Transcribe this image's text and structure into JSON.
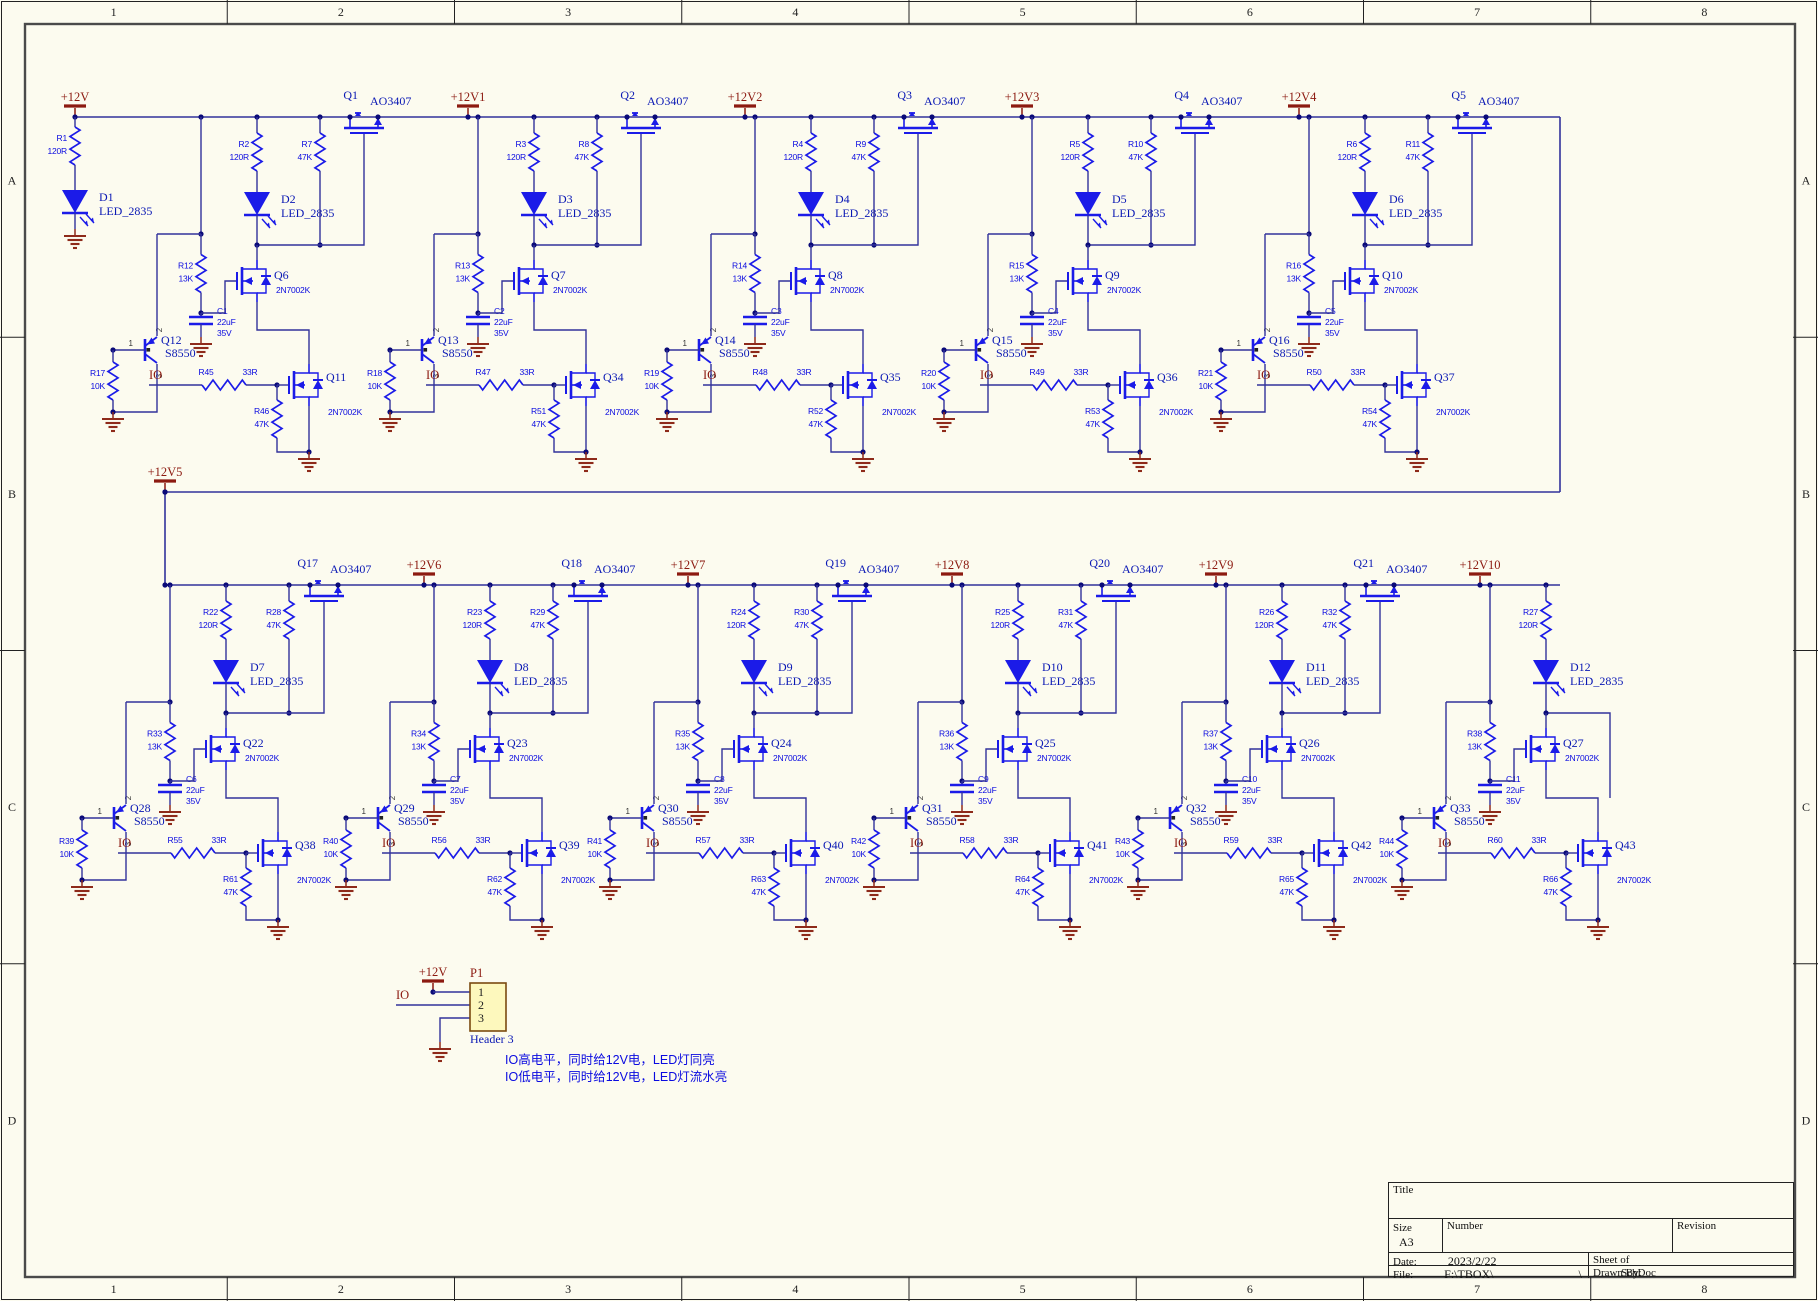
{
  "sheet": {
    "zones_cols": [
      "1",
      "2",
      "3",
      "4",
      "5",
      "6",
      "7",
      "8"
    ],
    "zones_rows": [
      "A",
      "B",
      "C",
      "D"
    ]
  },
  "colors": {
    "background": "#fcfbef",
    "wire": "#32329b",
    "part": "#1b1be8",
    "label": "#0a0ae0",
    "ref": "#0a18b4",
    "net": "#8c1a10",
    "ground": "#8e2a1a",
    "dot": "#0a0a78",
    "connector_fill": "#fdf8bd",
    "connector_stroke": "#7a4a10"
  },
  "power": {
    "main": "+12V",
    "mid": "+12V5"
  },
  "io_label": "IO",
  "first_led": {
    "res_ref": "R1",
    "res_val": "120R",
    "led_ref": "D1",
    "led_val": "LED_2835"
  },
  "pnp_pins": [
    "1",
    "2",
    "3"
  ],
  "top_units": [
    {
      "rail": "+12V1",
      "pass_ref": "Q1",
      "pass_val": "AO3407",
      "rled_ref": "R2",
      "rled_val": "120R",
      "led_ref": "D2",
      "led_val": "LED_2835",
      "r47_ref": "R7",
      "r47_val": "47K",
      "r13_ref": "R12",
      "r13_val": "13K",
      "qn_ref": "Q6",
      "qn_val": "2N7002K",
      "cap_ref": "C1",
      "cap_v1": "22uF",
      "cap_v2": "35V",
      "pnp_ref": "Q12",
      "pnp_val": "S8550",
      "r10_ref": "R17",
      "r10_val": "10K",
      "rio_ref": "R45",
      "rio_val": "33R",
      "qio_ref": "Q11",
      "qio_val": "2N7002K",
      "rpd_ref": "R46",
      "rpd_val": "47K"
    },
    {
      "rail": "+12V2",
      "pass_ref": "Q2",
      "pass_val": "AO3407",
      "rled_ref": "R3",
      "rled_val": "120R",
      "led_ref": "D3",
      "led_val": "LED_2835",
      "r47_ref": "R8",
      "r47_val": "47K",
      "r13_ref": "R13",
      "r13_val": "13K",
      "qn_ref": "Q7",
      "qn_val": "2N7002K",
      "cap_ref": "C2",
      "cap_v1": "22uF",
      "cap_v2": "35V",
      "pnp_ref": "Q13",
      "pnp_val": "S8550",
      "r10_ref": "R18",
      "r10_val": "10K",
      "rio_ref": "R47",
      "rio_val": "33R",
      "qio_ref": "Q34",
      "qio_val": "2N7002K",
      "rpd_ref": "R51",
      "rpd_val": "47K"
    },
    {
      "rail": "+12V3",
      "pass_ref": "Q3",
      "pass_val": "AO3407",
      "rled_ref": "R4",
      "rled_val": "120R",
      "led_ref": "D4",
      "led_val": "LED_2835",
      "r47_ref": "R9",
      "r47_val": "47K",
      "r13_ref": "R14",
      "r13_val": "13K",
      "qn_ref": "Q8",
      "qn_val": "2N7002K",
      "cap_ref": "C3",
      "cap_v1": "22uF",
      "cap_v2": "35V",
      "pnp_ref": "Q14",
      "pnp_val": "S8550",
      "r10_ref": "R19",
      "r10_val": "10K",
      "rio_ref": "R48",
      "rio_val": "33R",
      "qio_ref": "Q35",
      "qio_val": "2N7002K",
      "rpd_ref": "R52",
      "rpd_val": "47K"
    },
    {
      "rail": "+12V4",
      "pass_ref": "Q4",
      "pass_val": "AO3407",
      "rled_ref": "R5",
      "rled_val": "120R",
      "led_ref": "D5",
      "led_val": "LED_2835",
      "r47_ref": "R10",
      "r47_val": "47K",
      "r13_ref": "R15",
      "r13_val": "13K",
      "qn_ref": "Q9",
      "qn_val": "2N7002K",
      "cap_ref": "C4",
      "cap_v1": "22uF",
      "cap_v2": "35V",
      "pnp_ref": "Q15",
      "pnp_val": "S8550",
      "r10_ref": "R20",
      "r10_val": "10K",
      "rio_ref": "R49",
      "rio_val": "33R",
      "qio_ref": "Q36",
      "qio_val": "2N7002K",
      "rpd_ref": "R53",
      "rpd_val": "47K"
    },
    {
      "rail": "",
      "pass_ref": "Q5",
      "pass_val": "AO3407",
      "rled_ref": "R6",
      "rled_val": "120R",
      "led_ref": "D6",
      "led_val": "LED_2835",
      "r47_ref": "R11",
      "r47_val": "47K",
      "r13_ref": "R16",
      "r13_val": "13K",
      "qn_ref": "Q10",
      "qn_val": "2N7002K",
      "cap_ref": "C5",
      "cap_v1": "22uF",
      "cap_v2": "35V",
      "pnp_ref": "Q16",
      "pnp_val": "S8550",
      "r10_ref": "R21",
      "r10_val": "10K",
      "rio_ref": "R50",
      "rio_val": "33R",
      "qio_ref": "Q37",
      "qio_val": "2N7002K",
      "rpd_ref": "R54",
      "rpd_val": "47K"
    }
  ],
  "bottom_units": [
    {
      "rail": "+12V6",
      "pass_ref": "Q17",
      "pass_val": "AO3407",
      "rled_ref": "R22",
      "rled_val": "120R",
      "led_ref": "D7",
      "led_val": "LED_2835",
      "r47_ref": "R28",
      "r47_val": "47K",
      "r13_ref": "R33",
      "r13_val": "13K",
      "qn_ref": "Q22",
      "qn_val": "2N7002K",
      "cap_ref": "C6",
      "cap_v1": "22uF",
      "cap_v2": "35V",
      "pnp_ref": "Q28",
      "pnp_val": "S8550",
      "r10_ref": "R39",
      "r10_val": "10K",
      "rio_ref": "R55",
      "rio_val": "33R",
      "qio_ref": "Q38",
      "qio_val": "2N7002K",
      "rpd_ref": "R61",
      "rpd_val": "47K"
    },
    {
      "rail": "+12V7",
      "pass_ref": "Q18",
      "pass_val": "AO3407",
      "rled_ref": "R23",
      "rled_val": "120R",
      "led_ref": "D8",
      "led_val": "LED_2835",
      "r47_ref": "R29",
      "r47_val": "47K",
      "r13_ref": "R34",
      "r13_val": "13K",
      "qn_ref": "Q23",
      "qn_val": "2N7002K",
      "cap_ref": "C7",
      "cap_v1": "22uF",
      "cap_v2": "35V",
      "pnp_ref": "Q29",
      "pnp_val": "S8550",
      "r10_ref": "R40",
      "r10_val": "10K",
      "rio_ref": "R56",
      "rio_val": "33R",
      "qio_ref": "Q39",
      "qio_val": "2N7002K",
      "rpd_ref": "R62",
      "rpd_val": "47K"
    },
    {
      "rail": "+12V8",
      "pass_ref": "Q19",
      "pass_val": "AO3407",
      "rled_ref": "R24",
      "rled_val": "120R",
      "led_ref": "D9",
      "led_val": "LED_2835",
      "r47_ref": "R30",
      "r47_val": "47K",
      "r13_ref": "R35",
      "r13_val": "13K",
      "qn_ref": "Q24",
      "qn_val": "2N7002K",
      "cap_ref": "C8",
      "cap_v1": "22uF",
      "cap_v2": "35V",
      "pnp_ref": "Q30",
      "pnp_val": "S8550",
      "r10_ref": "R41",
      "r10_val": "10K",
      "rio_ref": "R57",
      "rio_val": "33R",
      "qio_ref": "Q40",
      "qio_val": "2N7002K",
      "rpd_ref": "R63",
      "rpd_val": "47K"
    },
    {
      "rail": "+12V9",
      "pass_ref": "Q20",
      "pass_val": "AO3407",
      "rled_ref": "R25",
      "rled_val": "120R",
      "led_ref": "D10",
      "led_val": "LED_2835",
      "r47_ref": "R31",
      "r47_val": "47K",
      "r13_ref": "R36",
      "r13_val": "13K",
      "qn_ref": "Q25",
      "qn_val": "2N7002K",
      "cap_ref": "C9",
      "cap_v1": "22uF",
      "cap_v2": "35V",
      "pnp_ref": "Q31",
      "pnp_val": "S8550",
      "r10_ref": "R42",
      "r10_val": "10K",
      "rio_ref": "R58",
      "rio_val": "33R",
      "qio_ref": "Q41",
      "qio_val": "2N7002K",
      "rpd_ref": "R64",
      "rpd_val": "47K"
    },
    {
      "rail": "+12V10",
      "pass_ref": "Q21",
      "pass_val": "AO3407",
      "rled_ref": "R26",
      "rled_val": "120R",
      "led_ref": "D11",
      "led_val": "LED_2835",
      "r47_ref": "R32",
      "r47_val": "47K",
      "r13_ref": "R37",
      "r13_val": "13K",
      "qn_ref": "Q26",
      "qn_val": "2N7002K",
      "cap_ref": "C10",
      "cap_v1": "22uF",
      "cap_v2": "35V",
      "pnp_ref": "Q32",
      "pnp_val": "S8550",
      "r10_ref": "R43",
      "r10_val": "10K",
      "rio_ref": "R59",
      "rio_val": "33R",
      "qio_ref": "Q42",
      "qio_val": "2N7002K",
      "rpd_ref": "R65",
      "rpd_val": "47K"
    },
    {
      "rail": "",
      "pass_ref": "",
      "pass_val": "",
      "rled_ref": "R27",
      "rled_val": "120R",
      "led_ref": "D12",
      "led_val": "LED_2835",
      "r47_ref": "",
      "r47_val": "",
      "r13_ref": "R38",
      "r13_val": "13K",
      "qn_ref": "Q27",
      "qn_val": "2N7002K",
      "cap_ref": "C11",
      "cap_v1": "22uF",
      "cap_v2": "35V",
      "pnp_ref": "Q33",
      "pnp_val": "S8550",
      "r10_ref": "R44",
      "r10_val": "10K",
      "rio_ref": "R60",
      "rio_val": "33R",
      "qio_ref": "Q43",
      "qio_val": "2N7002K",
      "rpd_ref": "R66",
      "rpd_val": "47K"
    }
  ],
  "connector": {
    "ref": "P1",
    "pins": [
      "1",
      "2",
      "3"
    ],
    "type": "Header 3",
    "power": "+12V",
    "io": "IO"
  },
  "notes": [
    "IO高电平，同时给12V电，LED灯同亮",
    "IO低电平，同时给12V电，LED灯流水亮"
  ],
  "title_block": {
    "title_label": "Title",
    "size_label": "Size",
    "size_value": "A3",
    "number_label": "Number",
    "revision_label": "Revision",
    "date_label": "Date:",
    "date_value": "2023/2/22",
    "file_label": "File:",
    "file_value": "F:\\TBOX\\",
    "file_value2": "\\",
    "sheet_label": "Sheet  of",
    "drawn_label": "Drawn By:",
    "drawn_overlay": "SchDoc"
  }
}
